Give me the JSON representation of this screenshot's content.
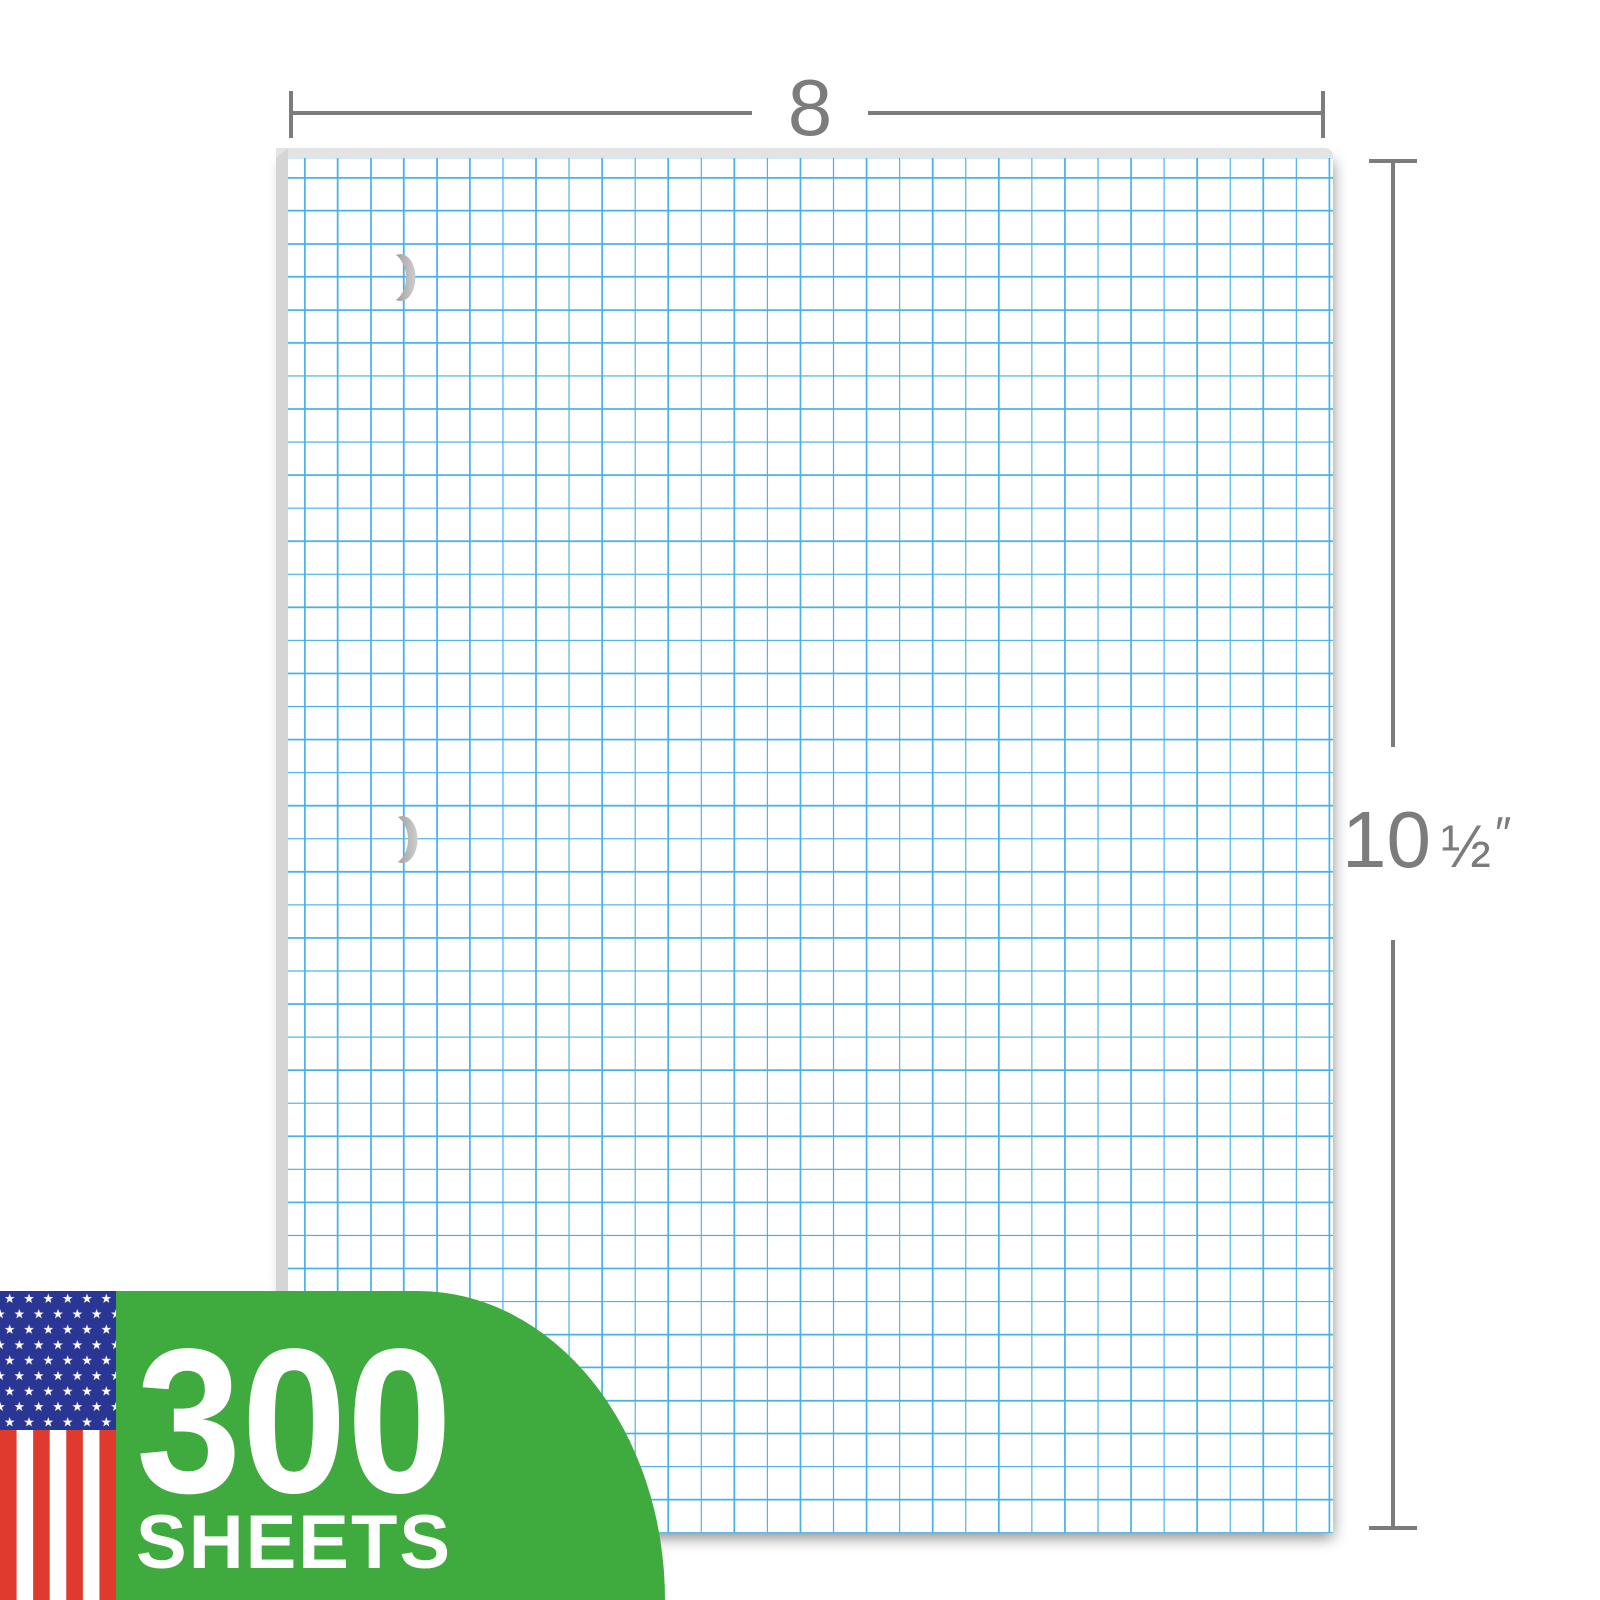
{
  "image": {
    "description": "Graph paper filler pad product illustration with size annotations",
    "background_color": "#FFFFFF"
  },
  "paper": {
    "type": "quad-ruled graph paper pad",
    "paper_color": "#FFFFFF",
    "grid_line_color": "#48B2E3",
    "top_edge_color": "#E3E3E3",
    "left_edge_color": "#D5D5D5",
    "hole_punches": {
      "icon": "hole-punch-crescent-icon",
      "visible_count": 2,
      "color": "#9A9A9A"
    }
  },
  "dimensions": {
    "annotation_color": "#7C7C7C",
    "width": {
      "label": "8"
    },
    "height": {
      "whole": "10",
      "fraction": "½",
      "unit": "″",
      "full": "10 ½″"
    }
  },
  "badge": {
    "count": "300",
    "unit": "SHEETS",
    "background_color": "#3FAB3F",
    "text_color": "#FFFFFF",
    "flag": {
      "icon": "us-flag-icon",
      "canton_color": "#2A3694",
      "stripe_red": "#E03A2E",
      "stripe_white": "#FFFFFF",
      "star_color": "#FFFFFF"
    }
  }
}
